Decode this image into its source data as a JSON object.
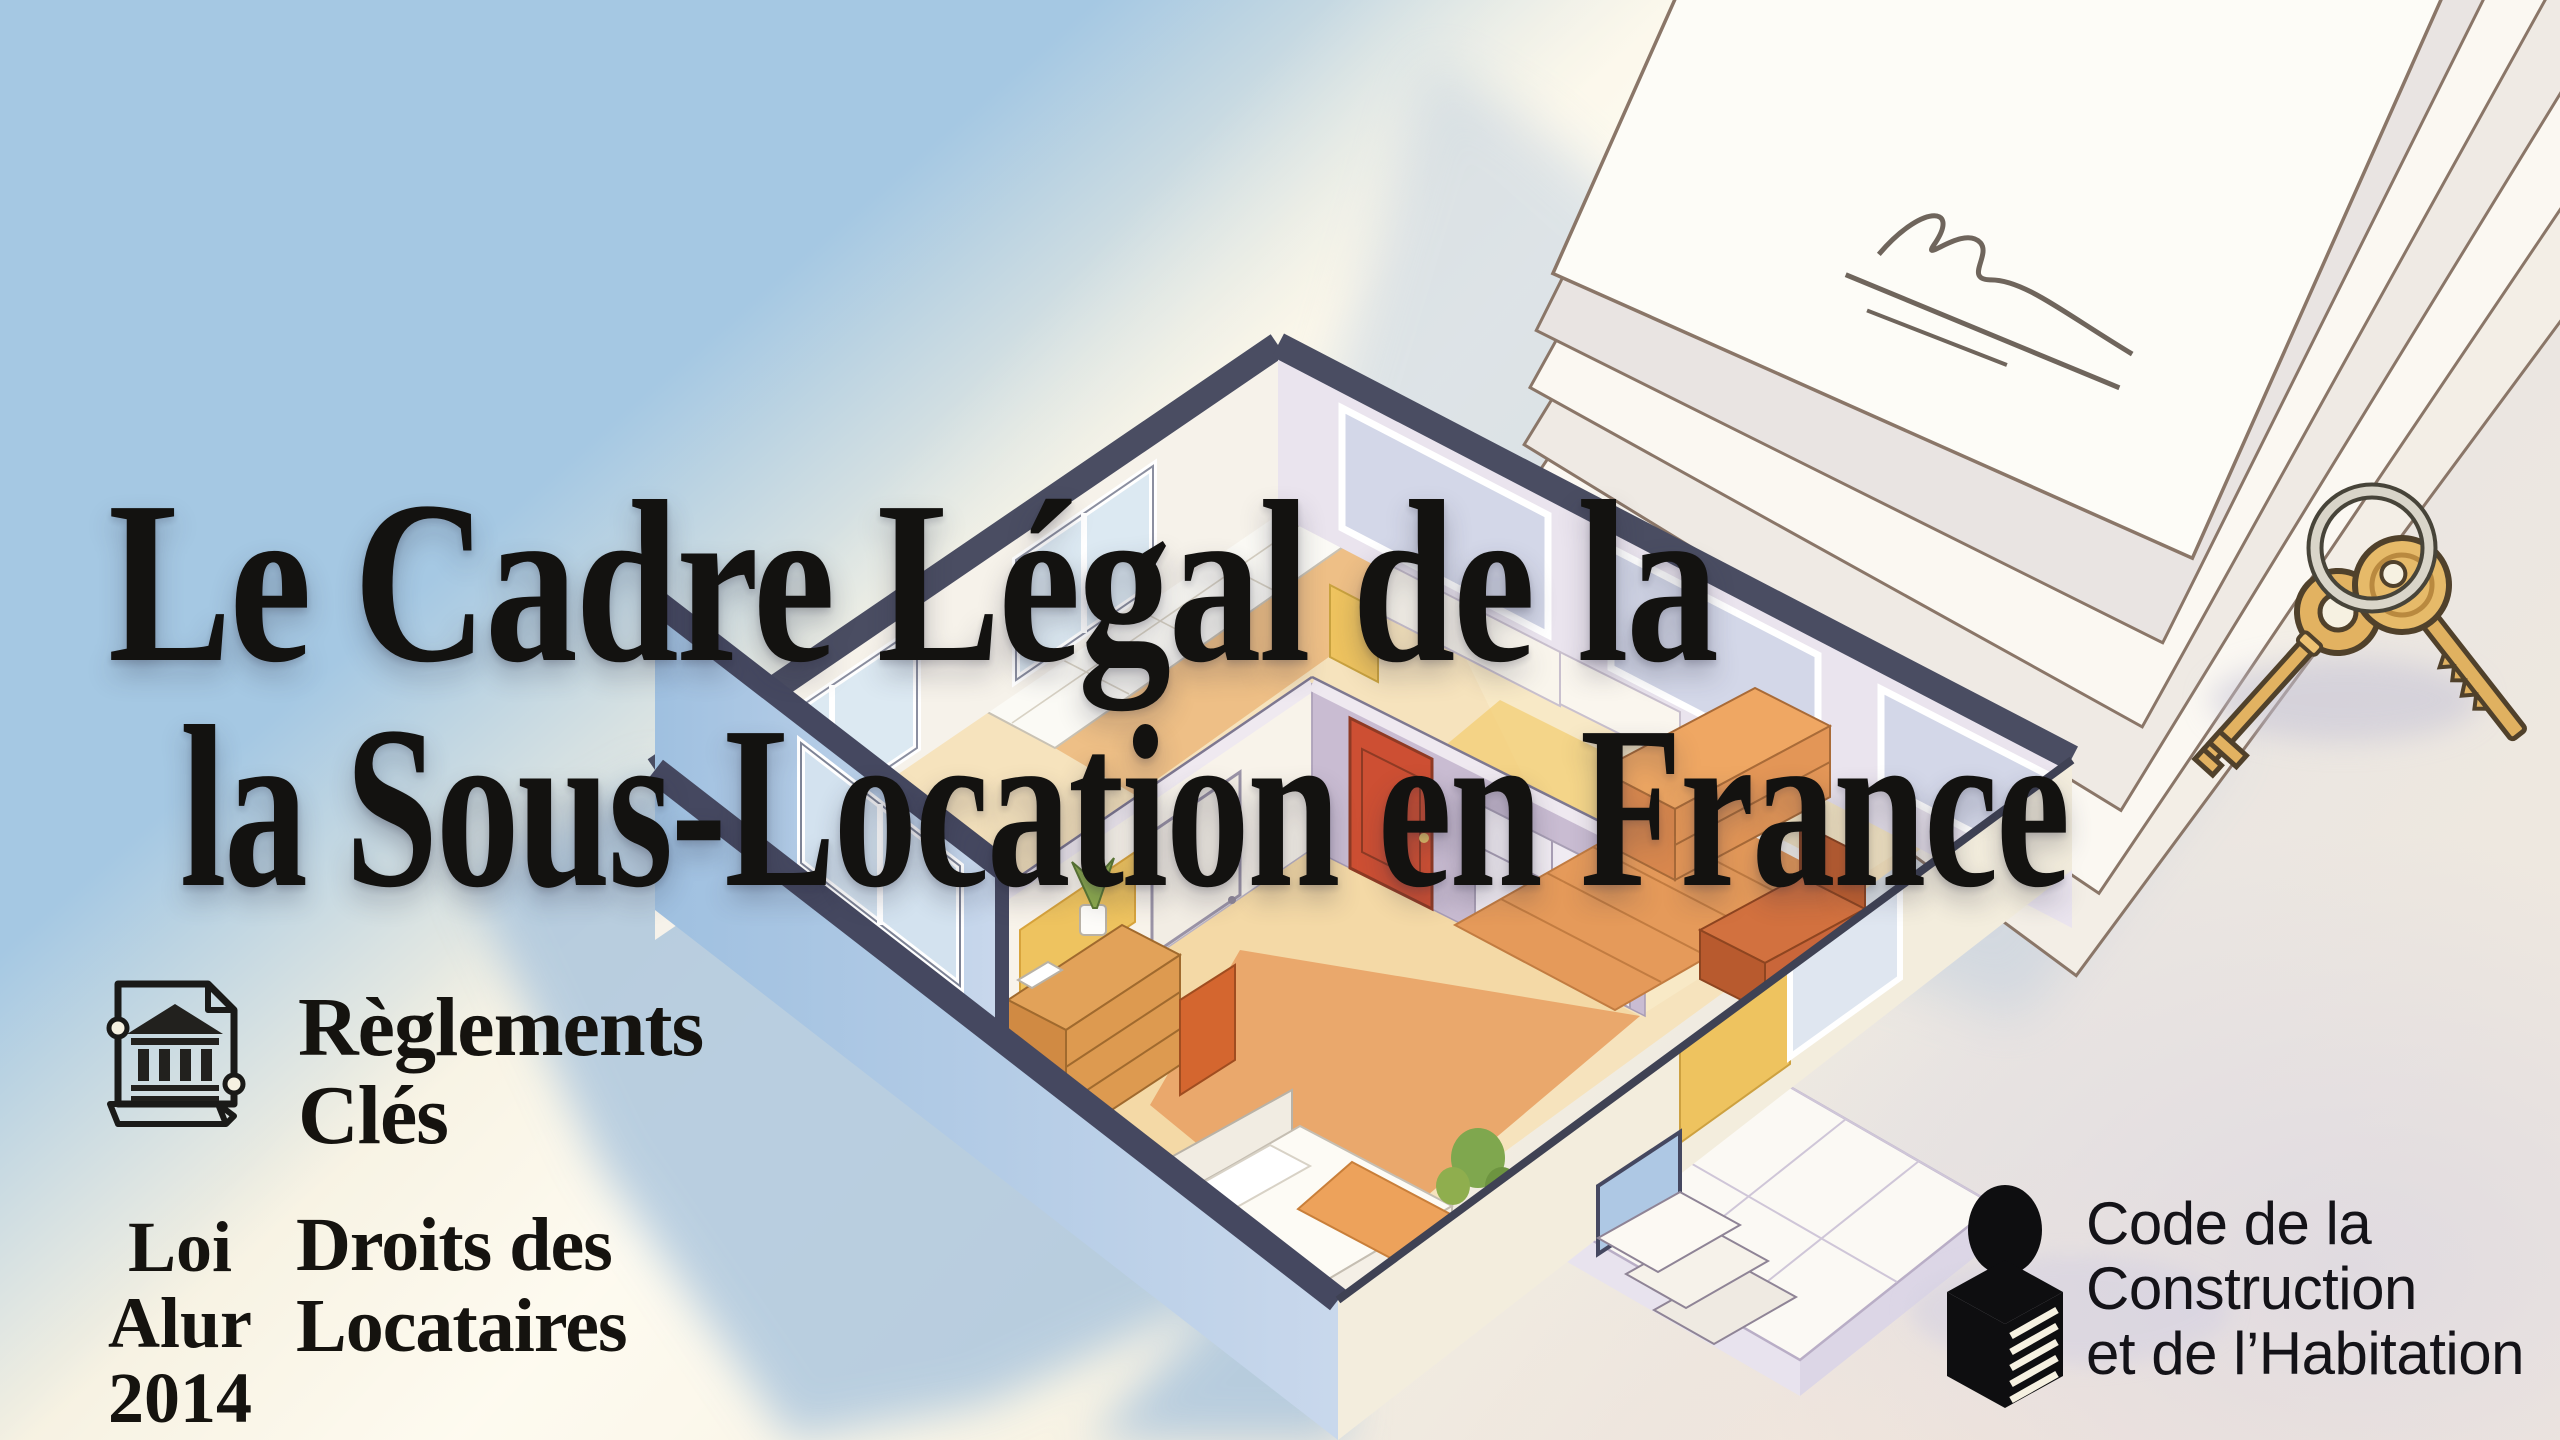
{
  "slide": {
    "language": "fr",
    "title": {
      "line1": "Le Cadre Légal de la",
      "line2": "la Sous-Location en France"
    },
    "callouts": {
      "reglements": {
        "icon": "legal-document-bank-icon",
        "line1": "Règlements",
        "line2": "Clés"
      },
      "loi_alur": {
        "line1": "Loi Alur",
        "line2": "2014"
      },
      "droits": {
        "line1": "Droits des",
        "line2": "Locataires"
      },
      "code_construction": {
        "icon": "reader-with-documents-icon",
        "line1": "Code de la",
        "line2": "Construction",
        "line3": "et de l’Habitation"
      }
    },
    "illustration": {
      "house": "isometric-cutaway-apartment-floorplan",
      "documents": "stack-of-signed-contracts",
      "signature": "handwritten-signature",
      "keys": "two-gold-keys-on-key-ring"
    },
    "palette": {
      "sky_blue": "#a5c8e3",
      "cream": "#f6f1e1",
      "ink": "#131210",
      "wall_top_navy": "#474a5e",
      "exterior_blue": "#aac6e2",
      "wood_light": "#f2d8a4",
      "wood_orange": "#e59a5c",
      "door_red": "#cd4f33",
      "accent_yellow": "#eec35f",
      "mauve_wall": "#c9bcd2",
      "key_gold": "#e0b160",
      "lavender_shadow": "#d8d4e2"
    }
  }
}
